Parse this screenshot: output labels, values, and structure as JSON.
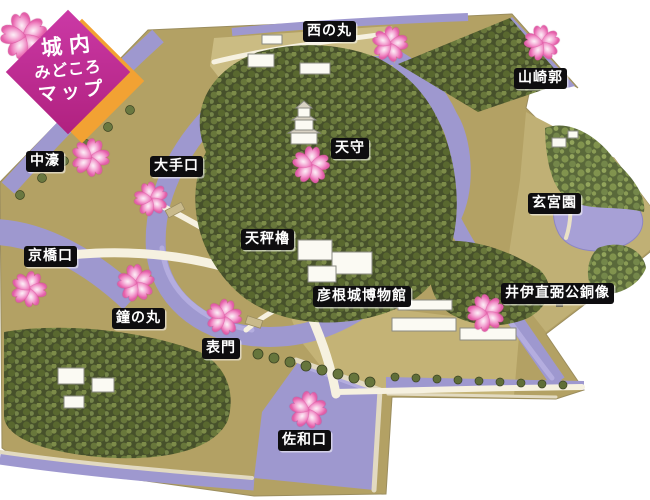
{
  "title": {
    "line1": "城内",
    "line2": "みどころ",
    "line3": "マップ"
  },
  "map": {
    "labels": [
      {
        "id": "nishinomaru",
        "text": "西の丸",
        "x": 303,
        "y": 21
      },
      {
        "id": "yamazaki-kuruwa",
        "text": "山崎郭",
        "x": 514,
        "y": 68
      },
      {
        "id": "nakabori",
        "text": "中濠",
        "x": 26,
        "y": 151
      },
      {
        "id": "oteguchi",
        "text": "大手口",
        "x": 150,
        "y": 156
      },
      {
        "id": "tenshu",
        "text": "天守",
        "x": 331,
        "y": 138
      },
      {
        "id": "genkyuen",
        "text": "玄宮園",
        "x": 528,
        "y": 193
      },
      {
        "id": "kyobashiguchi",
        "text": "京橋口",
        "x": 24,
        "y": 246
      },
      {
        "id": "tenbin-yagura",
        "text": "天秤櫓",
        "x": 241,
        "y": 229
      },
      {
        "id": "hikone-castle-museum",
        "text": "彦根城博物館",
        "x": 313,
        "y": 286
      },
      {
        "id": "ii-naosuke-statue",
        "text": "井伊直弼公銅像",
        "x": 501,
        "y": 283
      },
      {
        "id": "kanenomaru",
        "text": "鐘の丸",
        "x": 112,
        "y": 308
      },
      {
        "id": "omotemon",
        "text": "表門",
        "x": 202,
        "y": 338
      },
      {
        "id": "sawaguchi",
        "text": "佐和口",
        "x": 278,
        "y": 430
      }
    ],
    "flowers": [
      {
        "id": "title-corner",
        "x": 24,
        "y": 36,
        "size": 58,
        "rot": -12
      },
      {
        "id": "nishinomaru",
        "x": 390,
        "y": 44,
        "size": 44,
        "rot": 10
      },
      {
        "id": "yamazaki-kuruwa",
        "x": 542,
        "y": 43,
        "size": 44,
        "rot": -6
      },
      {
        "id": "nakabori",
        "x": 90,
        "y": 157,
        "size": 47,
        "rot": 18
      },
      {
        "id": "oteguchi",
        "x": 151,
        "y": 199,
        "size": 42,
        "rot": -14
      },
      {
        "id": "tenshu",
        "x": 311,
        "y": 165,
        "size": 46,
        "rot": 6
      },
      {
        "id": "kyobashiguchi",
        "x": 29,
        "y": 289,
        "size": 44,
        "rot": 22
      },
      {
        "id": "kanenomaru",
        "x": 136,
        "y": 283,
        "size": 46,
        "rot": -8
      },
      {
        "id": "omotemon",
        "x": 224,
        "y": 317,
        "size": 44,
        "rot": 14
      },
      {
        "id": "ii-naosuke-statue",
        "x": 486,
        "y": 313,
        "size": 46,
        "rot": -18
      },
      {
        "id": "sawaguchi",
        "x": 308,
        "y": 410,
        "size": 46,
        "rot": 8
      }
    ]
  },
  "colors": {
    "background": "#ffffff",
    "title_magenta": "#bd2b96",
    "title_orange": "#f2a233",
    "label_bg": "#0e0d0f",
    "label_text": "#ffffff",
    "moat_purple": "#9e98cf",
    "pond_purple": "#a7a0d6",
    "ground_tan": "#b3a164",
    "terrace_tan": "#cbbc83",
    "tree_green_dark": "#47512b",
    "tree_green_mid": "#5a693a",
    "path_cream": "#f6f1e0",
    "sakura_pink": "#ec74b8"
  }
}
